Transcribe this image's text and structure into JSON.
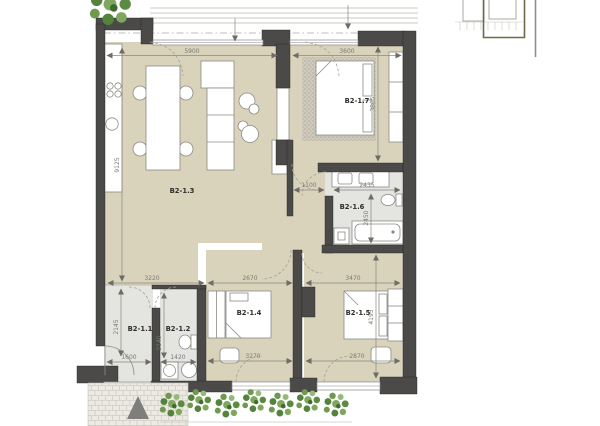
{
  "drawing": {
    "type": "apartment-floor-plan",
    "unit_labels_note": "room codes and dimension strings as printed on plan"
  },
  "rooms": {
    "r11": {
      "label": "B2-1.1"
    },
    "r12": {
      "label": "B2-1.2"
    },
    "r13": {
      "label": "B2-1.3"
    },
    "r14": {
      "label": "B2-1.4"
    },
    "r15": {
      "label": "B2-1.5"
    },
    "r16": {
      "label": "B2-1.6"
    },
    "r17": {
      "label": "B2-1.7"
    }
  },
  "dimensions": {
    "living_top": "5900",
    "bed7_top": "3600",
    "living_height": "9125",
    "bed7_height": "3805",
    "corridor_width": "1100",
    "bath_width": "2435",
    "bath_height": "2450",
    "hall_zone_top": "3220",
    "bed4_top": "2670",
    "bed5_top": "3470",
    "hall_height": "2145",
    "entry_bottom": "1600",
    "wc_bottom": "1420",
    "wc_height": "2140",
    "bed4_bottom": "3270",
    "bed5_bottom": "2870",
    "bed5_height": "4195"
  },
  "colors": {
    "floor_beige": "#d9d3bc",
    "floor_wet_gray": "#e4e4e0",
    "wall_dark": "#4b4a48",
    "plant_green": "#6f9a4e",
    "keyplan_accent": "#6e6a49"
  }
}
